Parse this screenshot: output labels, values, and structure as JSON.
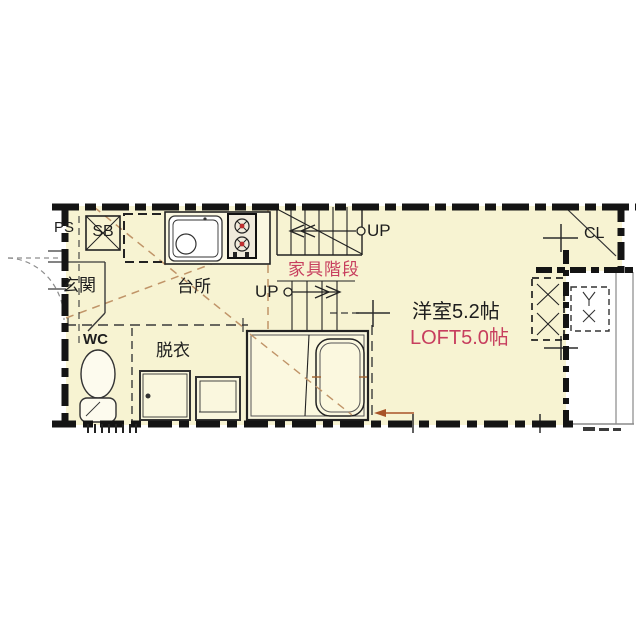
{
  "labels": {
    "pipe_space": "PS",
    "storage_box": "SB",
    "entrance": "玄関",
    "kitchen": "台所",
    "toilet": "WC",
    "dressing_room": "脱衣",
    "furniture_stairs": "家具階段",
    "up_upper": "UP",
    "up_lower": "UP",
    "closet": "CL",
    "western_room": "洋室5.2帖",
    "loft": "LOFT5.0帖"
  },
  "colors": {
    "floor": "#f7f3d2",
    "wall": "#141414",
    "accent_red": "#c73e5e",
    "loft_guide_tan": "#c09468"
  }
}
